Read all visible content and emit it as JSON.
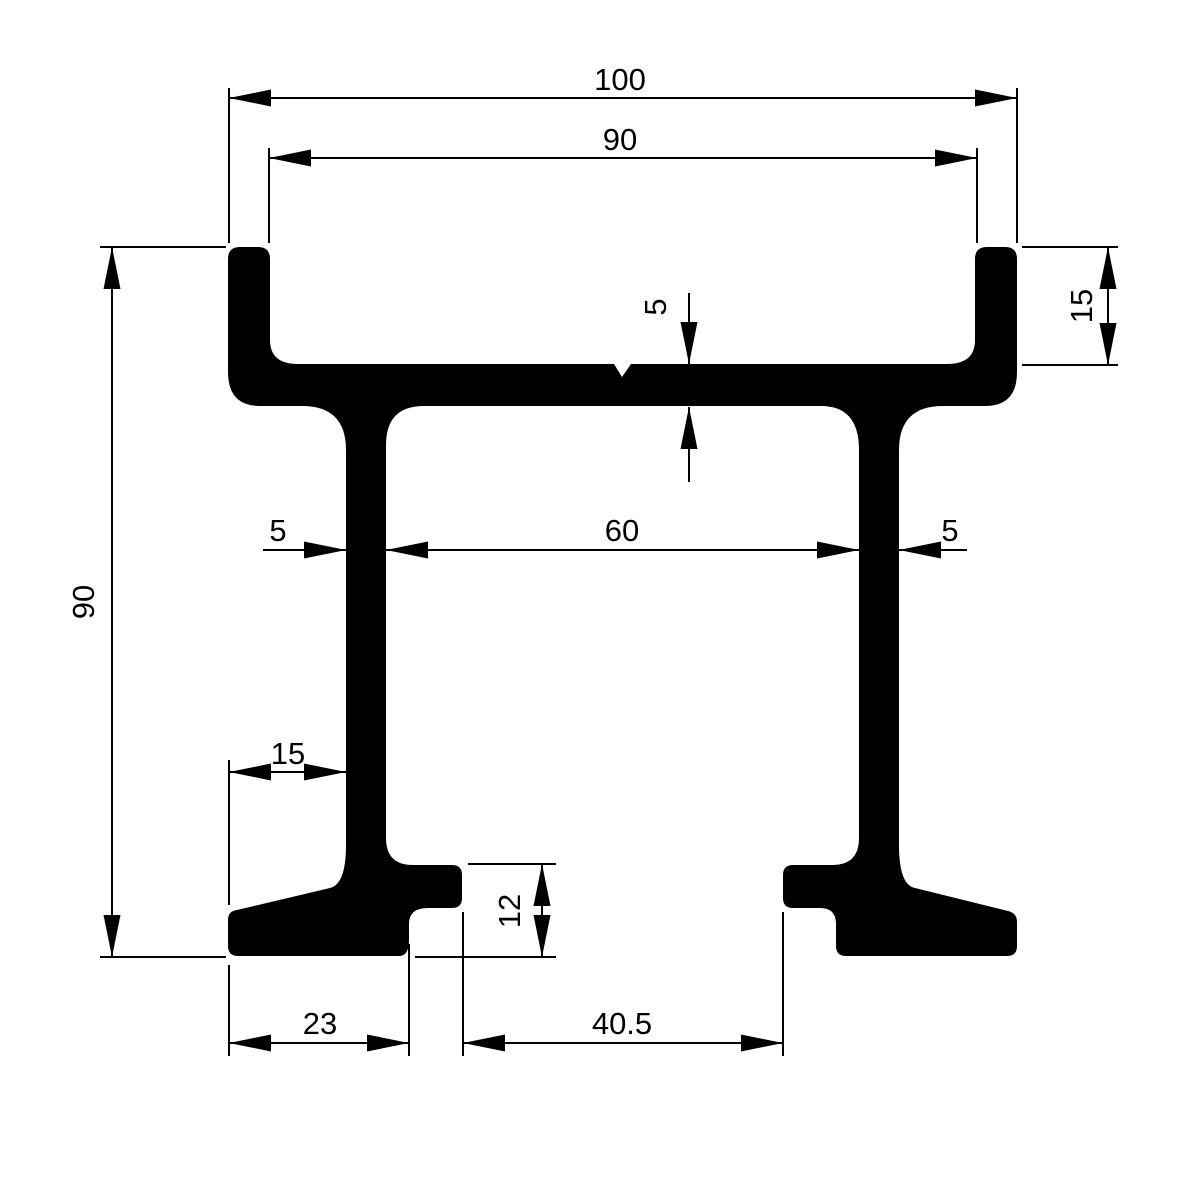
{
  "drawing": {
    "type": "technical-cross-section",
    "subject": "double-web rail profile cross section with top flange, two webs and two feet",
    "background_color": "#ffffff",
    "ink_color": "#000000"
  },
  "dims": {
    "overall_width": "100",
    "flange_inner_width": "90",
    "lip_height": "15",
    "plate_thickness": "5",
    "overall_height": "90",
    "web_left_thickness": "5",
    "web_inner_spacing": "60",
    "web_right_thickness": "5",
    "foot_left_offset": "15",
    "foot_height": "12",
    "foot_width": "23",
    "feet_inner_gap": "40.5"
  }
}
